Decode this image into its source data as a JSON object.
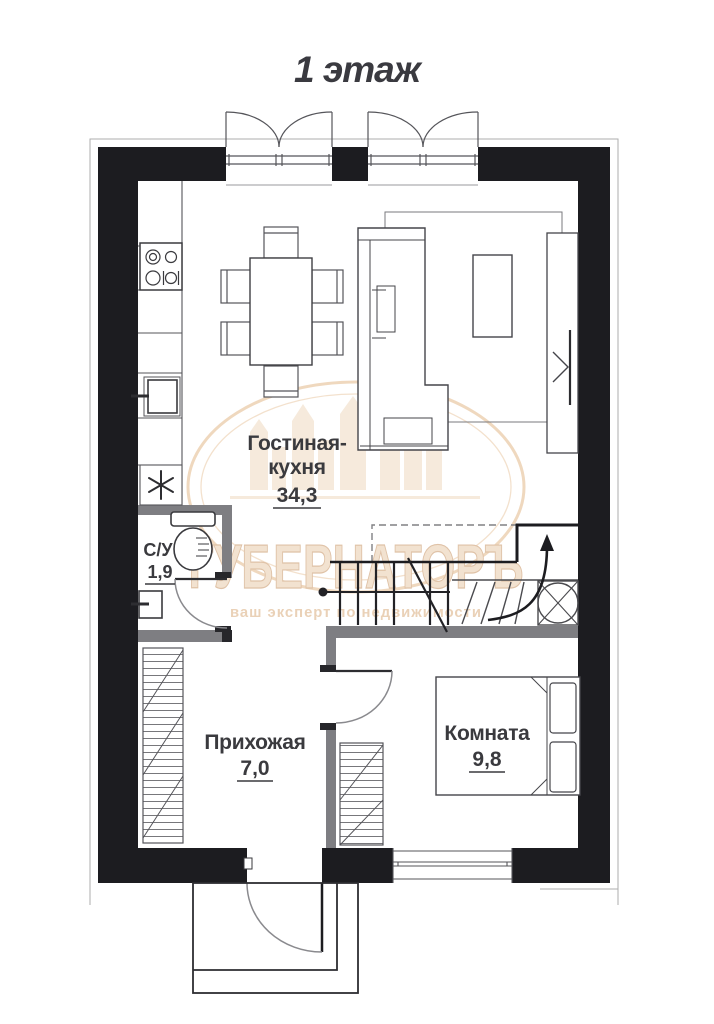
{
  "title": "1 этаж",
  "rooms": [
    {
      "name": "Гостиная-кухня",
      "name_lines": [
        "Гостиная-",
        "кухня"
      ],
      "area": "34,3"
    },
    {
      "name": "С/У",
      "name_lines": [
        "С/У"
      ],
      "area": "1,9"
    },
    {
      "name": "Прихожая",
      "name_lines": [
        "Прихожая"
      ],
      "area": "7,0"
    },
    {
      "name": "Комната",
      "name_lines": [
        "Комната"
      ],
      "area": "9,8"
    }
  ],
  "watermark": {
    "brand": "ГУБЕРНАТОРЪ",
    "tagline": "ваш эксперт по недвижимости"
  },
  "icons": {
    "refrigerator-snowflake": "✳",
    "stairs-direction": "↑"
  },
  "colors": {
    "wall": "#1c1c20",
    "partition": "#7e7e82",
    "furniture_line": "#4a4a4e",
    "label": "#3a3a3e",
    "watermark_tan": "#e7cbad"
  }
}
